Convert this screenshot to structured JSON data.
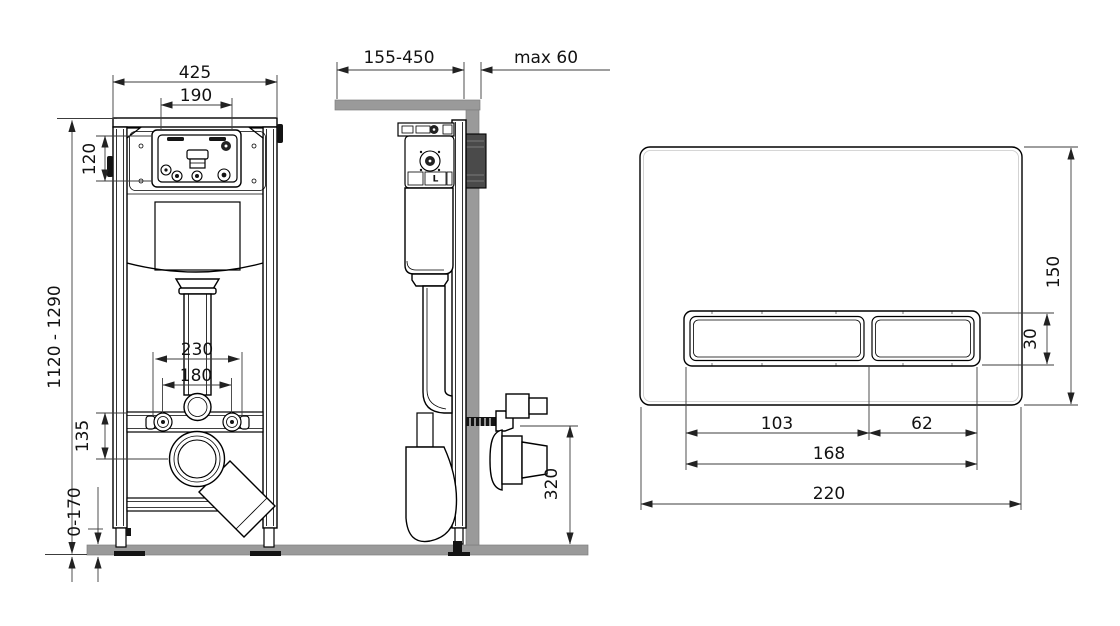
{
  "drawing_title": "concealed-wc-frame-installation-diagram",
  "dims": {
    "front_width": "425",
    "opening_width": "190",
    "opening_height": "120",
    "install_height": "1120 - 1290",
    "outer_spacing": "230",
    "bolt_spacing": "180",
    "drain_offset": "135",
    "feet_adjust": "0-170",
    "depth_range": "155-450",
    "wall_max": "max 60",
    "outlet_height": "320",
    "plate_height": "150",
    "button_height": "30",
    "button_large_width": "103",
    "button_small_width": "62",
    "buttons_total_width": "168",
    "plate_width": "220"
  },
  "marks": {
    "cistern_label": "L"
  },
  "colors": {
    "line": "#000000",
    "dimension_line": "#3c3c3c",
    "wall_floor_gray": "#9a9a9a",
    "dark_mount_box": "#4a4a4a",
    "background": "#ffffff"
  }
}
